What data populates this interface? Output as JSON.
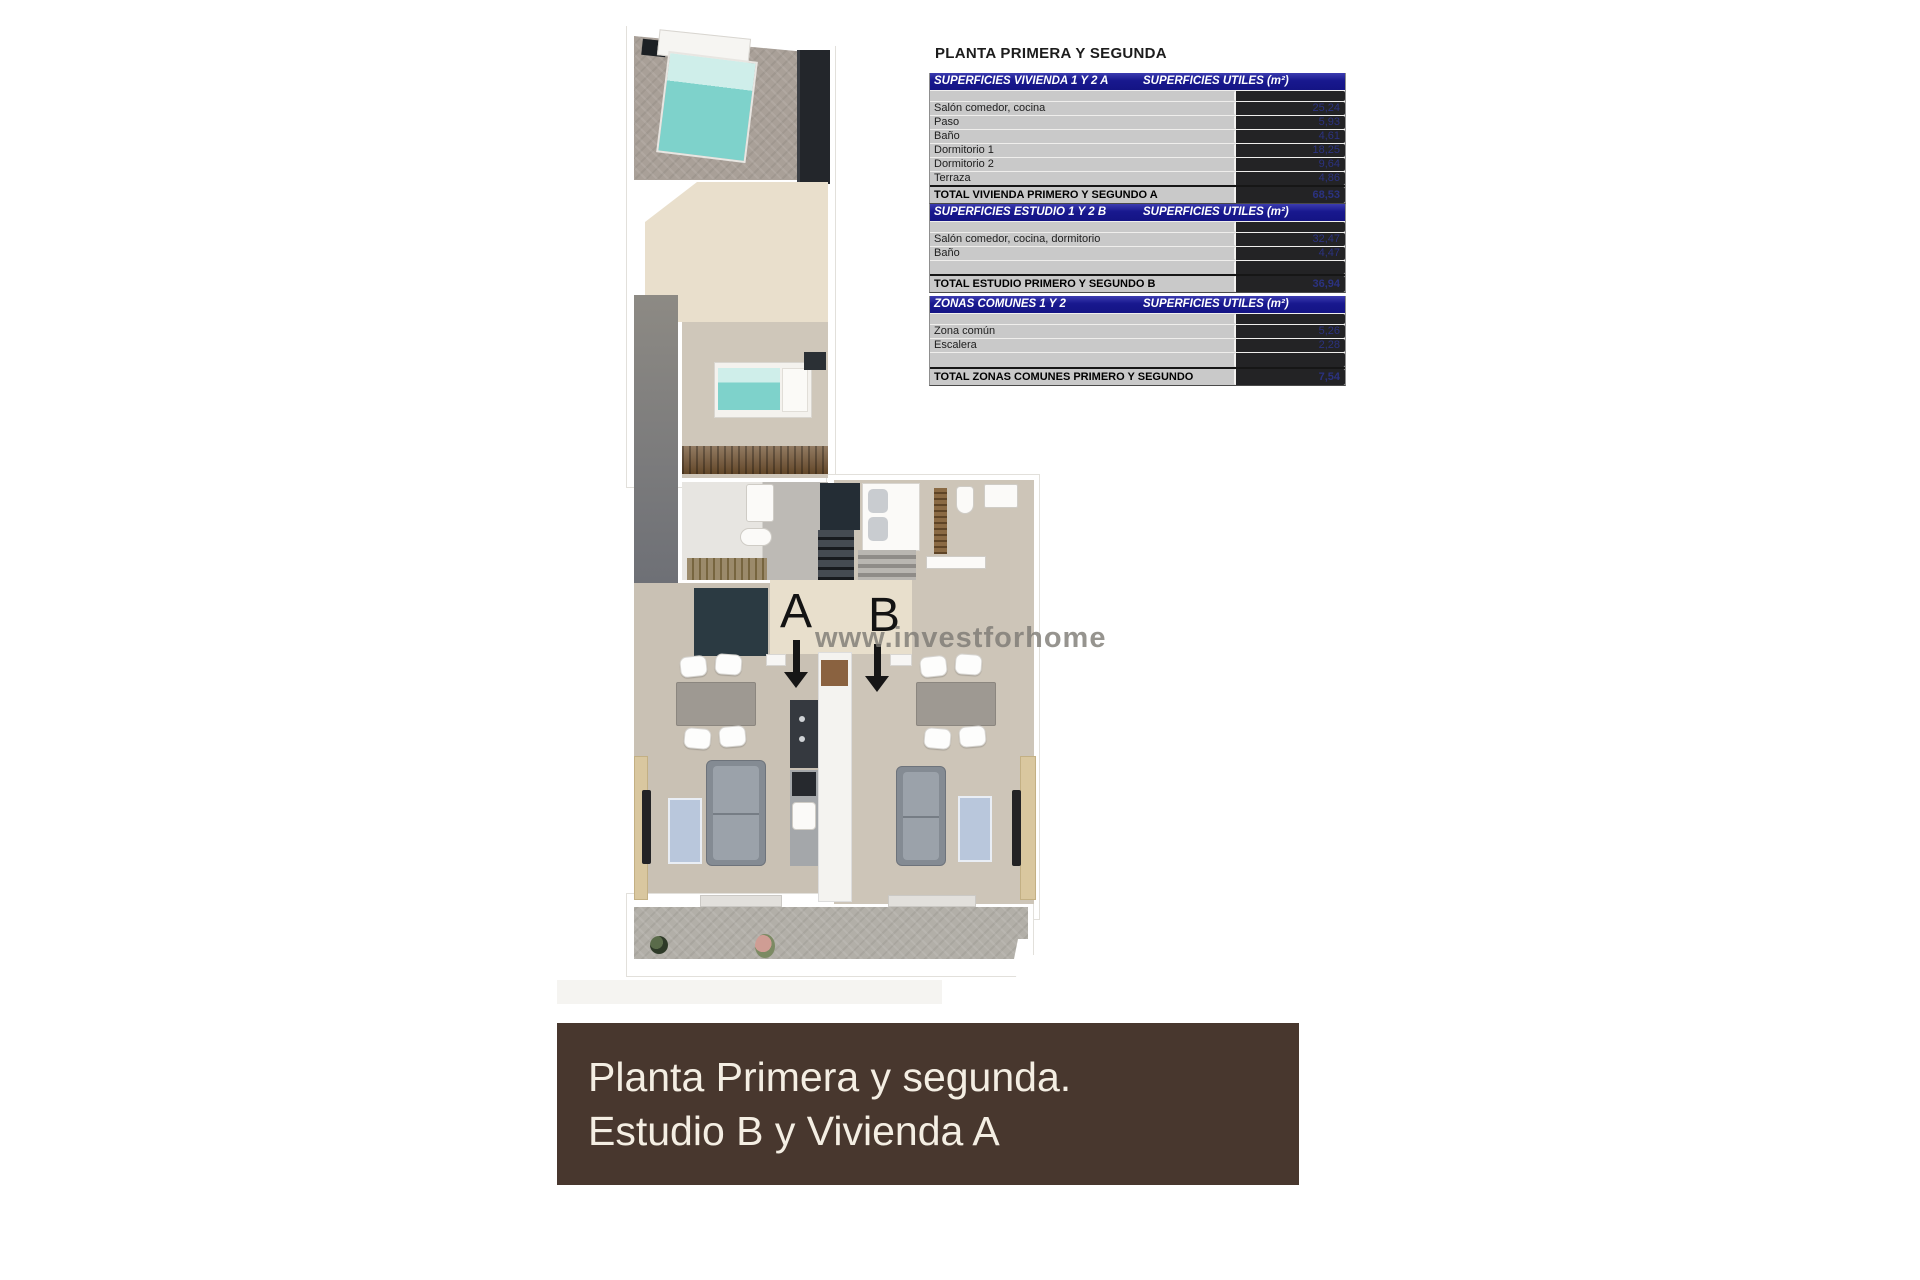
{
  "page": {
    "title": "PLANTA PRIMERA Y SEGUNDA"
  },
  "tables": [
    {
      "header_left": "SUPERFICIES VIVIENDA 1 Y 2 A",
      "header_right": "SUPERFICIES UTILES  (m²)",
      "rows": [
        {
          "label": "Salón comedor, cocina",
          "value": "25,24"
        },
        {
          "label": "Paso",
          "value": "5,93"
        },
        {
          "label": "Baño",
          "value": "4,61"
        },
        {
          "label": "Dormitorio 1",
          "value": "18,25"
        },
        {
          "label": "Dormitorio 2",
          "value": "9,64"
        },
        {
          "label": "Terraza",
          "value": "4,86"
        }
      ],
      "total_label": "TOTAL VIVIENDA PRIMERO Y SEGUNDO A",
      "total_value": "68,53"
    },
    {
      "header_left": "SUPERFICIES ESTUDIO 1 Y 2 B",
      "header_right": "SUPERFICIES UTILES  (m²)",
      "rows": [
        {
          "label": "Salón comedor, cocina, dormitorio",
          "value": "32,47"
        },
        {
          "label": "Baño",
          "value": "4,47"
        }
      ],
      "total_label": "TOTAL ESTUDIO PRIMERO Y SEGUNDO B",
      "total_value": "36,94"
    },
    {
      "header_left": "ZONAS COMUNES 1 Y 2",
      "header_right": "SUPERFICIES UTILES  (m²)",
      "rows": [
        {
          "label": "Zona común",
          "value": "5,26"
        },
        {
          "label": "Escalera",
          "value": "2,28"
        }
      ],
      "total_label": "TOTAL ZONAS COMUNES PRIMERO Y SEGUNDO",
      "total_value": "7,54"
    }
  ],
  "plan": {
    "unit_a_label": "A",
    "unit_b_label": "B",
    "watermark": "www.investforhome"
  },
  "banner": {
    "line1": "Planta Primera y segunda.",
    "line2": "Estudio B y Vivienda A"
  },
  "colors": {
    "table_header_bg": "#18188e",
    "table_row_bg": "#c9c9c9",
    "table_value_text": "#2b3280",
    "banner_bg": "#48372e",
    "banner_text": "#f4eee3",
    "bed_teal": "#7ed2cb",
    "rug_blue": "#b9c7dc"
  }
}
